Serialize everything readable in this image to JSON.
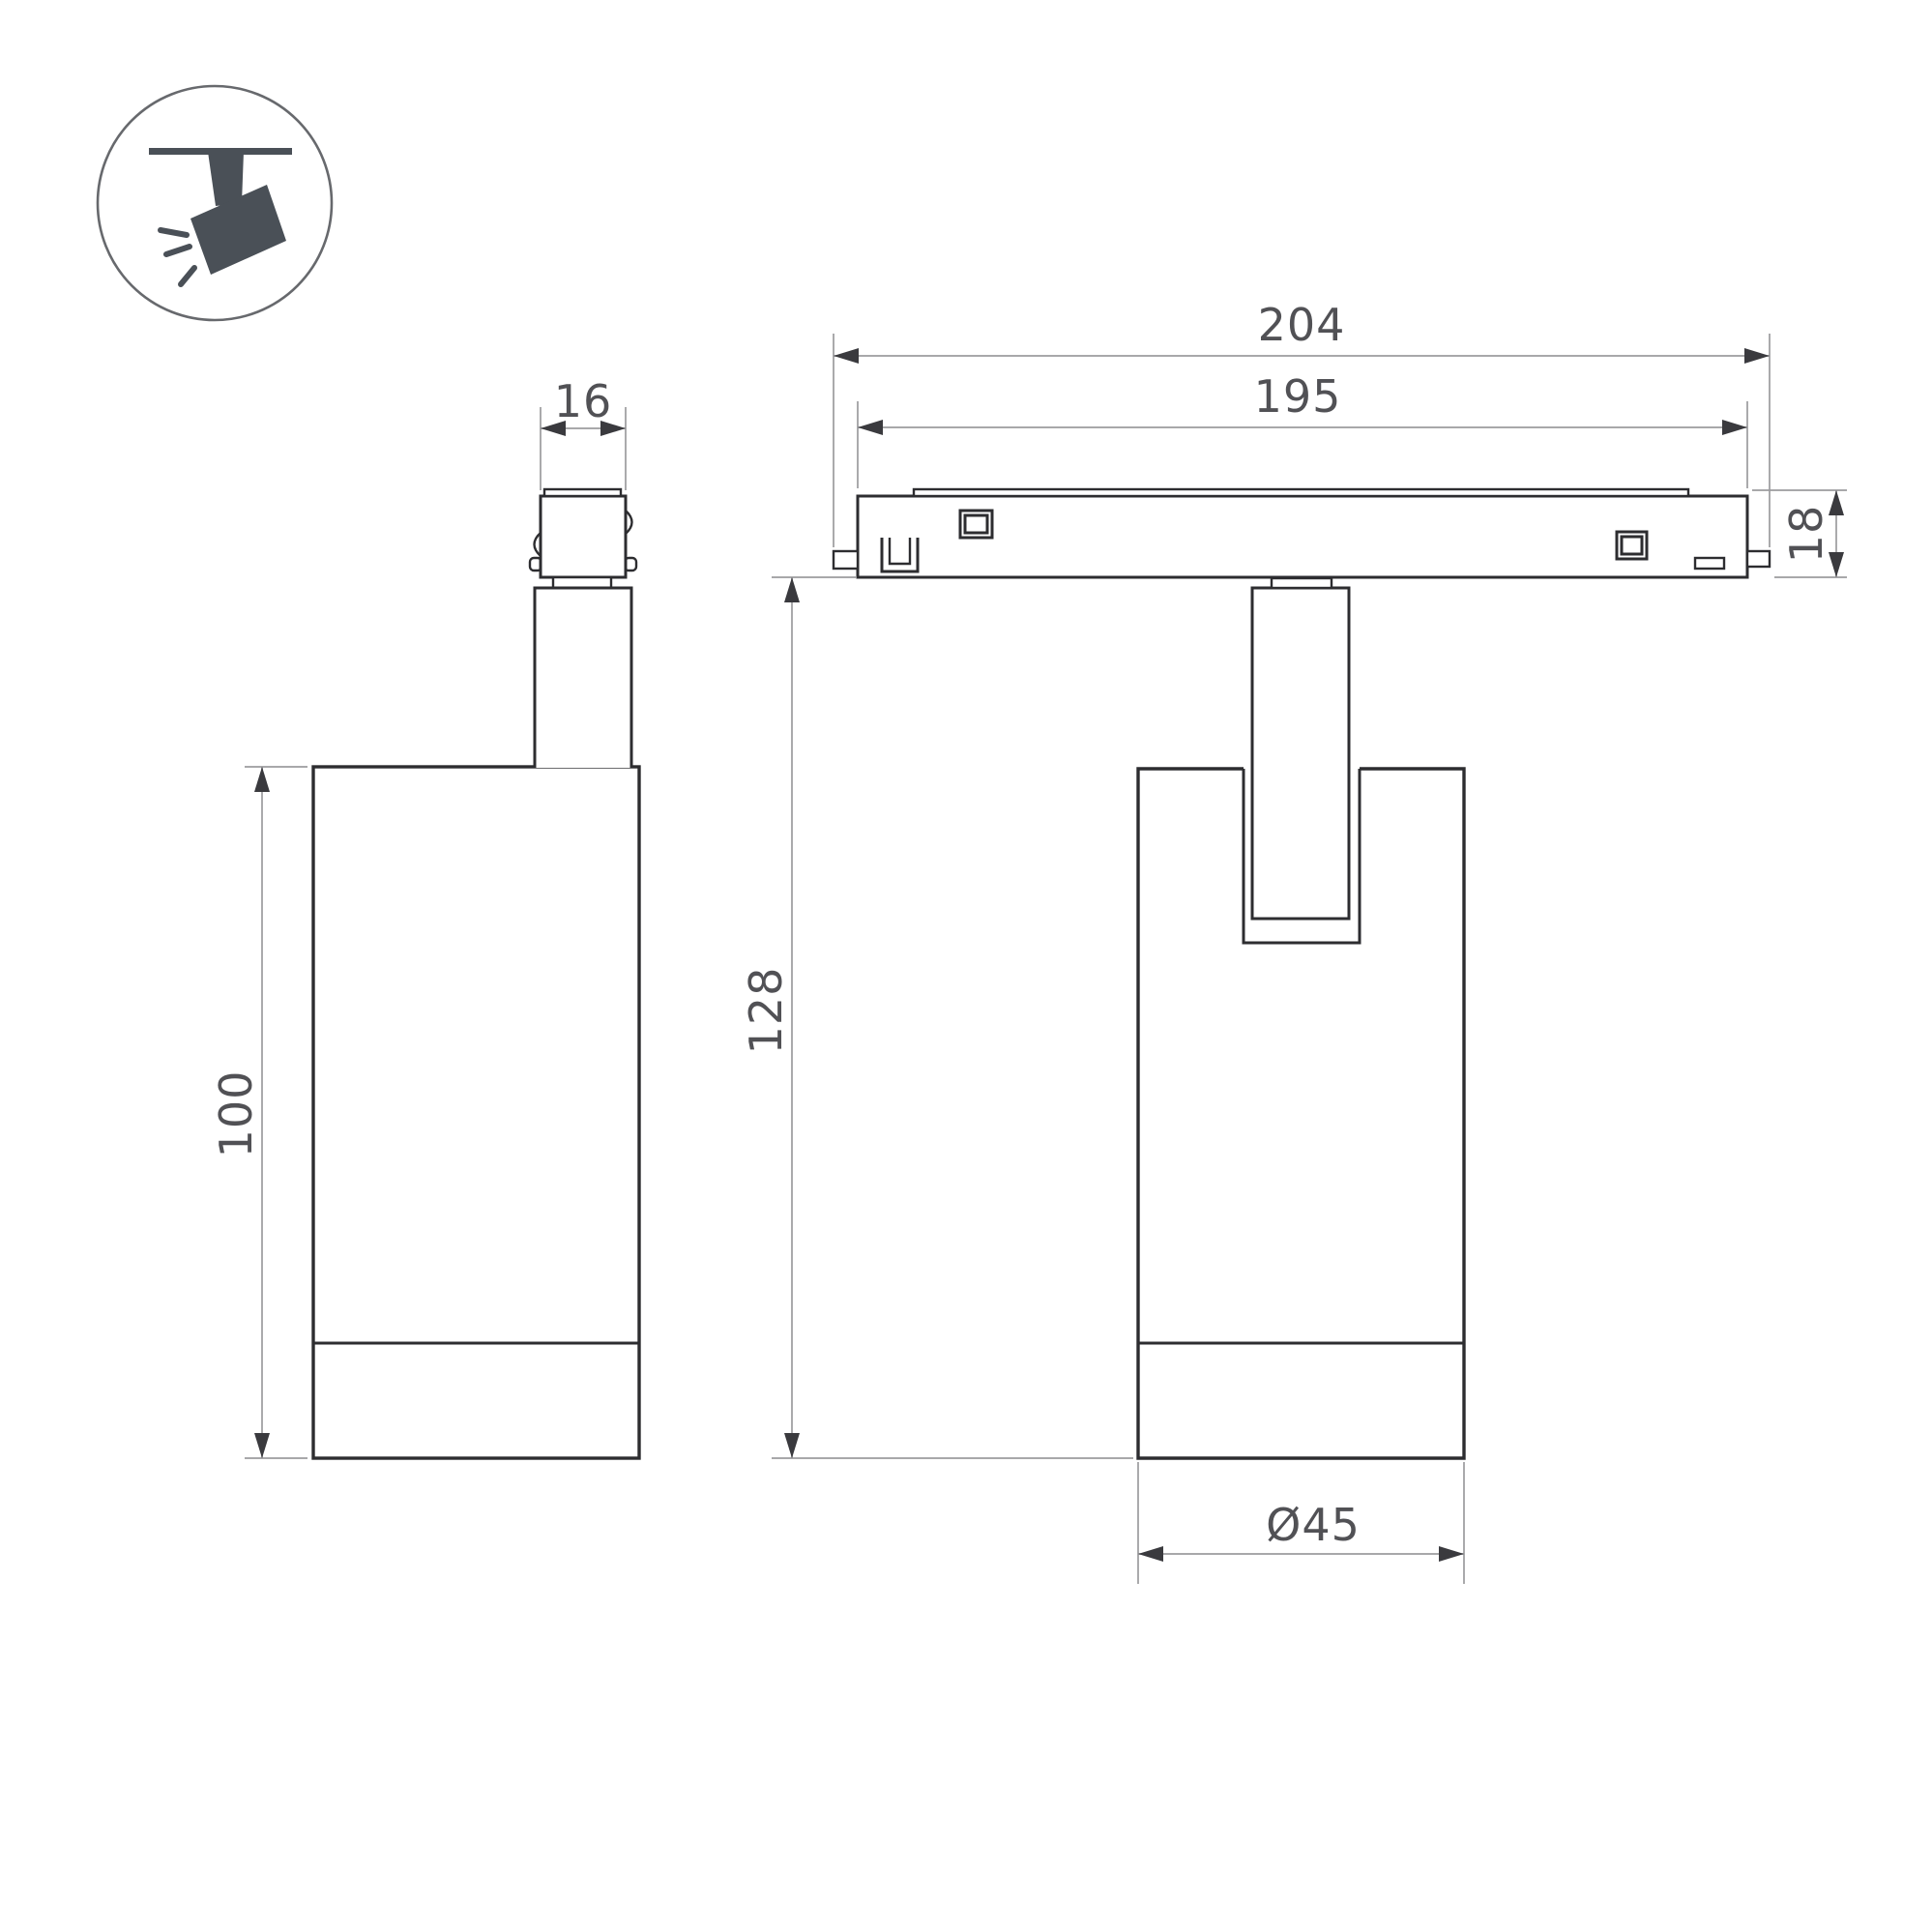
{
  "drawing": {
    "type": "technical-dimension-drawing",
    "subject": "magnetic track spotlight",
    "views": {
      "side_view": "side view of spotlight with track adapter",
      "front_view": "front view of spotlight on track"
    },
    "dimensions": {
      "track_overall_length": "204",
      "rail_length": "195",
      "track_height": "18",
      "adapter_width": "16",
      "housing_height": "100",
      "overall_height": "128",
      "housing_diameter": "Ø45"
    },
    "icon": {
      "name": "track-spotlight-pictogram",
      "description": "ceiling-mounted adjustable spotlight with light rays"
    },
    "colors": {
      "line": "#2d2d30",
      "dimension_line": "#9b9b9e",
      "arrowhead": "#3a3a3e",
      "label_text": "#515155",
      "icon_fill": "#4a5057",
      "icon_ring": "#67696d",
      "background": "#ffffff"
    }
  }
}
